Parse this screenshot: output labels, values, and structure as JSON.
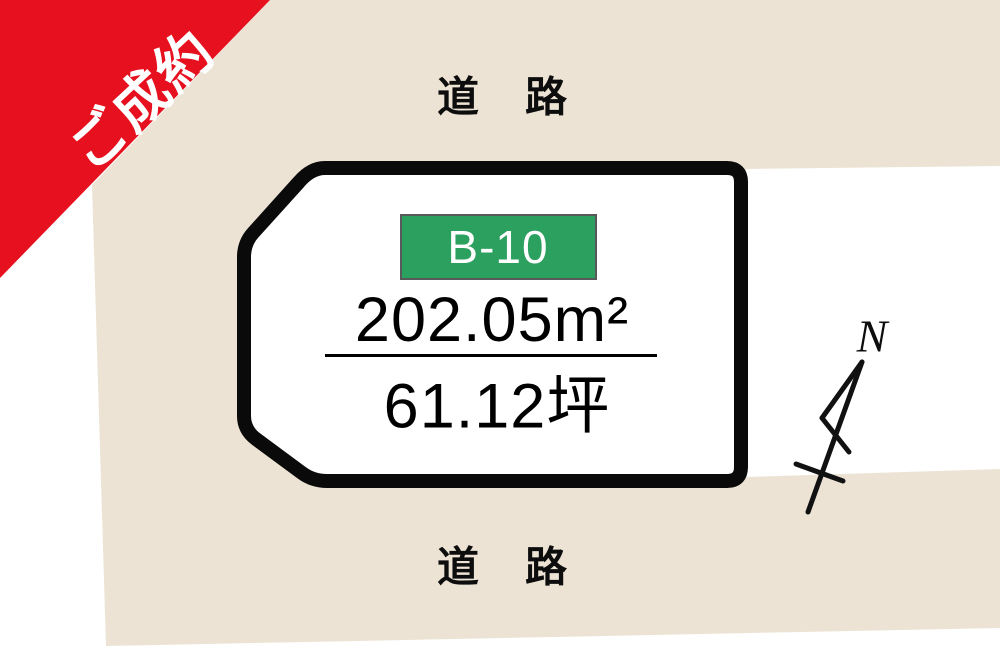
{
  "ribbon": {
    "label": "ご成約",
    "color": "#e6101e",
    "text_color": "#ffffff"
  },
  "roads": {
    "top_label": "道　路",
    "bottom_label": "道　路"
  },
  "lot": {
    "id_badge": {
      "label": "B-10",
      "bg_color": "#2ba05f",
      "border_color": "#58595b",
      "text_color": "#ffffff"
    },
    "area_sqm": "202.05m²",
    "area_tsubo": "61.12坪"
  },
  "compass": {
    "north_label": "N"
  },
  "colors": {
    "land": "#ece3d4",
    "road_white": "#ffffff",
    "lot_fill": "#ffffff",
    "lot_border": "#0a0a0a"
  }
}
